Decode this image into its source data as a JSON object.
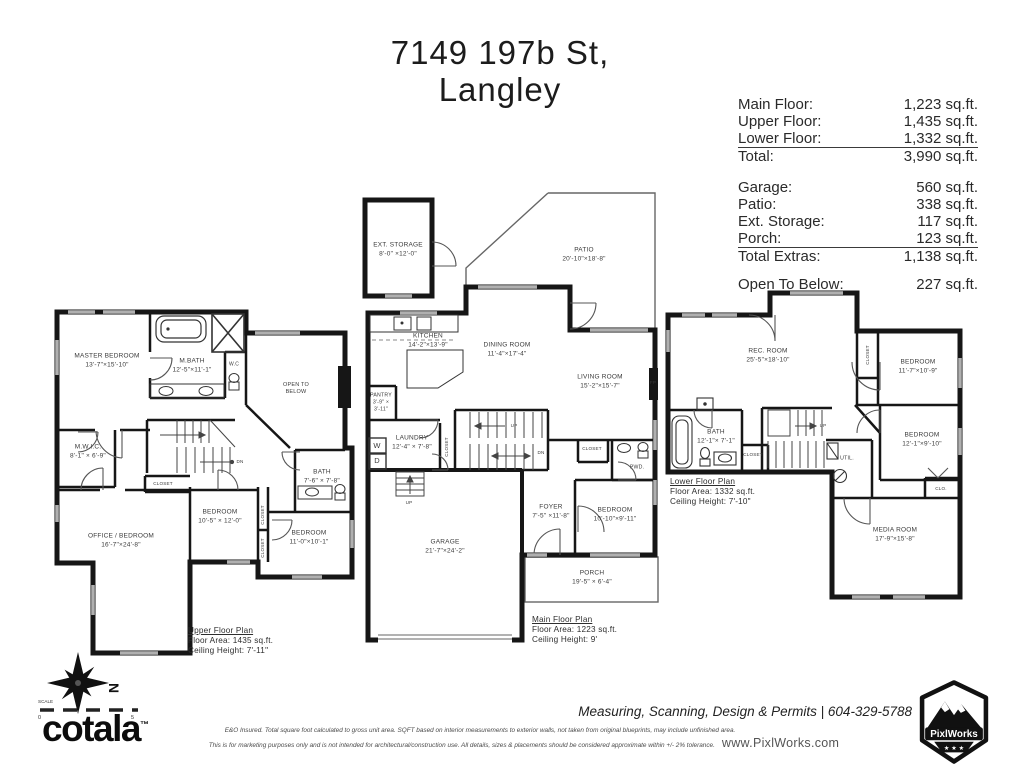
{
  "title": {
    "line1": "7149 197b St,",
    "line2": "Langley"
  },
  "summary": {
    "floor_rows": [
      {
        "label": "Main Floor:",
        "value": "1,223 sq.ft."
      },
      {
        "label": "Upper Floor:",
        "value": "1,435 sq.ft."
      },
      {
        "label": "Lower Floor:",
        "value": "1,332 sq.ft."
      }
    ],
    "total_row": {
      "label": "Total:",
      "value": "3,990 sq.ft."
    },
    "extra_rows": [
      {
        "label": "Garage:",
        "value": "560 sq.ft."
      },
      {
        "label": "Patio:",
        "value": "338 sq.ft."
      },
      {
        "label": "Ext. Storage:",
        "value": "117 sq.ft."
      },
      {
        "label": "Porch:",
        "value": "123 sq.ft."
      }
    ],
    "total_extras_row": {
      "label": "Total Extras:",
      "value": "1,138 sq.ft."
    },
    "open_to_below_row": {
      "label": "Open To Below:",
      "value": "227 sq.ft."
    }
  },
  "plans": [
    {
      "id": "upper-floor",
      "caption": {
        "title": "Upper Floor Plan",
        "area": "Floor Area: 1435 sq.ft.",
        "ceiling": "Ceiling Height: 7'-11\""
      },
      "rooms": [
        {
          "name": "MASTER BEDROOM",
          "dims": "13'-7\"×15'-10\"",
          "x": 107,
          "y": 361
        },
        {
          "name": "M.BATH",
          "dims": "12'-5\"×11'-1\"",
          "x": 192,
          "y": 366
        },
        {
          "name": "W.C",
          "x": 234,
          "y": 365,
          "fs": 5
        },
        {
          "name": "OPEN TO\nBELOW",
          "x": 296,
          "y": 389,
          "fs": 5.5
        },
        {
          "name": "M.W.I.C.",
          "dims": "8'-1\" × 6'-9\"",
          "x": 88,
          "y": 452
        },
        {
          "name": "OFFICE / BEDROOM",
          "dims": "16'-7\"×24'-8\"",
          "x": 121,
          "y": 541
        },
        {
          "name": "BEDROOM",
          "dims": "10'-5\" × 12'-0\"",
          "x": 220,
          "y": 517
        },
        {
          "name": "BATH",
          "dims": "7'-6\" × 7'-8\"",
          "x": 322,
          "y": 477
        },
        {
          "name": "BEDROOM",
          "dims": "11'-0\"×10'-1\"",
          "x": 309,
          "y": 538
        },
        {
          "name": "CLOSET",
          "x": 163,
          "y": 484,
          "fs": 4.6
        },
        {
          "name": "CLOSET",
          "x": 263,
          "y": 515,
          "fs": 4.6,
          "rot": -90
        },
        {
          "name": "CLOSET",
          "x": 263,
          "y": 548,
          "fs": 4.6,
          "rot": -90
        },
        {
          "name": "DN",
          "x": 240,
          "y": 462,
          "fs": 4.6
        }
      ]
    },
    {
      "id": "main-floor",
      "caption": {
        "title": "Main Floor Plan",
        "area": "Floor Area: 1223 sq.ft.",
        "ceiling": "Ceiling Height: 9'"
      },
      "rooms": [
        {
          "name": "EXT. STORAGE",
          "dims": "8'-0\" ×12'-0\"",
          "x": 398,
          "y": 250
        },
        {
          "name": "PATIO",
          "dims": "20'-10\"×18'-8\"",
          "x": 584,
          "y": 255
        },
        {
          "name": "KITCHEN",
          "dims": "14'-2\"×13'-9\"",
          "x": 428,
          "y": 341
        },
        {
          "name": "DINING ROOM",
          "dims": "11'-4\"×17'-4\"",
          "x": 507,
          "y": 350
        },
        {
          "name": "LIVING ROOM",
          "dims": "15'-2\"×15'-7\"",
          "x": 600,
          "y": 382
        },
        {
          "name": "FP",
          "x": 653,
          "y": 383,
          "fs": 4.6
        },
        {
          "name": "PANTRY",
          "dims": "3'-9\" ×\n3'-11\"",
          "x": 381,
          "y": 403,
          "fs": 5.2
        },
        {
          "name": "LAUNDRY",
          "dims": "12'-4\" × 7'-8\"",
          "x": 412,
          "y": 443
        },
        {
          "name": "W",
          "x": 377,
          "y": 446,
          "fs": 7.5
        },
        {
          "name": "D",
          "x": 377,
          "y": 461,
          "fs": 7.5
        },
        {
          "name": "CLOSET",
          "x": 447,
          "y": 447,
          "fs": 4.6,
          "rot": -90
        },
        {
          "name": "UP",
          "x": 514,
          "y": 426,
          "fs": 4.6
        },
        {
          "name": "DN",
          "x": 541,
          "y": 453,
          "fs": 4.6
        },
        {
          "name": "UP",
          "x": 409,
          "y": 503,
          "fs": 4.6
        },
        {
          "name": "FOYER",
          "dims": "7'-5\" ×11'-8\"",
          "x": 551,
          "y": 512
        },
        {
          "name": "BEDROOM",
          "dims": "10'-10\"×9'-11\"",
          "x": 615,
          "y": 515
        },
        {
          "name": "PWD.",
          "x": 637,
          "y": 468,
          "fs": 5.2
        },
        {
          "name": "CLOSET",
          "x": 592,
          "y": 449,
          "fs": 4.6
        },
        {
          "name": "GARAGE",
          "dims": "21'-7\"×24'-2\"",
          "x": 445,
          "y": 547
        },
        {
          "name": "PORCH",
          "dims": "19'-5\" × 6'-4\"",
          "x": 592,
          "y": 578
        }
      ]
    },
    {
      "id": "lower-floor",
      "caption": {
        "title": "Lower Floor Plan",
        "area": "Floor Area: 1332 sq.ft.",
        "ceiling": "Ceiling Height: 7'-10\""
      },
      "rooms": [
        {
          "name": "REC. ROOM",
          "dims": "25'-5\"×18'-10\"",
          "x": 768,
          "y": 356
        },
        {
          "name": "CLOSET",
          "x": 868,
          "y": 355,
          "fs": 4.6,
          "rot": -90
        },
        {
          "name": "BEDROOM",
          "dims": "11'-7\"×10'-9\"",
          "x": 918,
          "y": 367
        },
        {
          "name": "BEDROOM",
          "dims": "12'-1\"×9'-10\"",
          "x": 922,
          "y": 440
        },
        {
          "name": "BATH",
          "dims": "12'-1\"× 7'-1\"",
          "x": 716,
          "y": 437
        },
        {
          "name": "CLOSET",
          "x": 753,
          "y": 455,
          "fs": 4.6
        },
        {
          "name": "UP",
          "x": 823,
          "y": 426,
          "fs": 4.6
        },
        {
          "name": "UTIL.",
          "x": 847,
          "y": 459,
          "fs": 5.2
        },
        {
          "name": "CLO.",
          "x": 941,
          "y": 489,
          "fs": 4.6
        },
        {
          "name": "MEDIA ROOM",
          "dims": "17'-9\"×15'-8\"",
          "x": 895,
          "y": 535
        }
      ]
    }
  ],
  "footer": {
    "compass_label": "N",
    "scale_label": "SCALE",
    "scale_start": "0",
    "scale_end": "5",
    "brand": "cotala",
    "brand_tm": "™",
    "disclaimer_line1": "E&O Insured.  Total square foot calculated to gross unit area. SQFT based on interior measurements to exterior walls, not taken from original blueprints, may include unfinished area.",
    "disclaimer_line2": "This is for marketing purposes only and is not intended for architectural/construction use.  All details, sizes & placements should be considered approximate within +/- 2%  tolerance.",
    "services": "Measuring, Scanning, Design & Permits | 604-329-5788",
    "website": "www.PixlWorks.com",
    "badge_text": "PixlWorks"
  },
  "colors": {
    "wall": "#161616",
    "window": "#b0b0b0",
    "text": "#333333"
  }
}
